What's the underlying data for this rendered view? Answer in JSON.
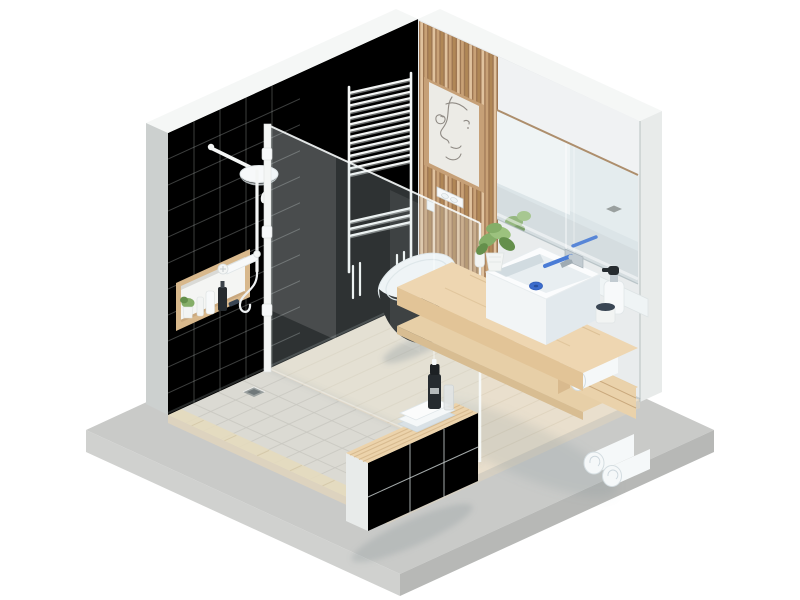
{
  "scene": {
    "label": "isometric-bathroom-3d-render",
    "type": "3d-render",
    "view": "isometric",
    "background": "#ffffff"
  },
  "palette": {
    "bg": "#ffffff",
    "slabTop": "#c9cac8",
    "slabLeft": "#d0d1cf",
    "slabRight": "#b7b8b6",
    "floorWood": "#e9dfcd",
    "plankLine": "#d9cdb6",
    "floorEdgeL": "#ddd3bf",
    "floorEdgeR": "#d5cfc2",
    "showerTile": "#dbdad3",
    "tileGrout": "#c9c8c1",
    "curbTile": "#e4dabe",
    "curbLine": "#d3c6a6",
    "drainMetal": "#9aa09f",
    "drainDark": "#70787a",
    "wallMain": "#eef1f0",
    "wallShower": "#d9dddc",
    "wallTop": "#f5f7f6",
    "wallEnd": "#ccd0cf",
    "wallTileLine": "#c6cccb",
    "rightWall": "#e9eced",
    "pillar": "#e8ebea",
    "pillarEdge": "#d7dad9",
    "slatPanelBg": "#9e7753",
    "slatA": "#e0c29e",
    "slatB": "#c8a176",
    "slatC": "#b08756",
    "frameWood": "#c6a077",
    "matCream": "#ecebe6",
    "lineArt": "#8f8a84",
    "mirrorBase": "#dce5e8",
    "mirrorBright": "#eff4f5",
    "mirrorMid": "#e4ecee",
    "mirrorFloor": "#d5dde0",
    "mirrorTrim": "#ad8e6c",
    "radiatorWhite": "#f4f6f5",
    "radiatorShade": "#d2d7d6",
    "fixtureWhite": "#f7f9fa",
    "fixtureShade": "#dce3e6",
    "fixtureLine": "#c9d2d7",
    "toiletSide": "#d6dee2",
    "nicheWood": "#d8b88c",
    "nicheBack": "#f4f5f3",
    "counterTop": "#eed6b1",
    "counterFront": "#e2c497",
    "shelfWood": "#e7cfa7",
    "shelfFront": "#d8bd92",
    "boxFace": "#ead2ab",
    "boxSide": "#d9ba8e",
    "boxLine": "#c9a87c",
    "towelWhite": "#f5f8f9",
    "towelShade": "#d9e1e6",
    "towelBlue": "#dfeaf2",
    "towelLine": "#cdd7dd",
    "plantGreen": "#85ae68",
    "plantDark": "#648f4b",
    "plantLight": "#9cc27e",
    "potWhite": "#f2f4f3",
    "accentBlue": "#4a7cd6",
    "drainBlue": "#3b6ccc",
    "chrome": "#c2cbd1",
    "chromeDark": "#9fabb3",
    "black": "#262b2f",
    "blackSoft": "#3c434a",
    "navy": "#3a4654",
    "sinkLight": "#f2f5f6",
    "sinkShade": "#e2e9ed",
    "basinInner": "#e8eef1",
    "benchFace": "#eff2f1",
    "benchEnd": "#e8ebea",
    "benchShade": "#d7dddf",
    "benchWood": "#ecd3ab",
    "benchSlat": "#d8bb90",
    "glassFill": "rgba(208,226,230,0.22)",
    "glassEdge": "rgba(248,252,252,0.9)",
    "glassSeam": "rgba(255,255,255,0.5)"
  },
  "objects": [
    {
      "id": "base-slab",
      "label": "concrete platform base"
    },
    {
      "id": "wood-floor",
      "label": "light wood plank floor"
    },
    {
      "id": "shower-floor",
      "label": "tiled shower floor with drain"
    },
    {
      "id": "left-wall",
      "label": "left wall with shower"
    },
    {
      "id": "right-wall",
      "label": "back right wall with mirror"
    },
    {
      "id": "wood-slat-panel",
      "label": "vertical wood slat feature panel"
    },
    {
      "id": "wall-art",
      "label": "framed one-line face drawing"
    },
    {
      "id": "towel-radiator",
      "label": "white ladder towel rack"
    },
    {
      "id": "glass-partition",
      "label": "frameless shower glass screen"
    },
    {
      "id": "shower-set",
      "label": "white rain shower column"
    },
    {
      "id": "shower-niche",
      "label": "wooden wall niche with toiletries"
    },
    {
      "id": "toilet",
      "label": "wall-hung toilet"
    },
    {
      "id": "flush-plate",
      "label": "dual flush plate"
    },
    {
      "id": "mirror",
      "label": "large wall mirror"
    },
    {
      "id": "vanity",
      "label": "floating wood vanity with shelf"
    },
    {
      "id": "sink",
      "label": "square vessel sink with blue drain"
    },
    {
      "id": "faucet",
      "label": "wall faucet with blue lever"
    },
    {
      "id": "soap-dispenser",
      "label": "pump soap dispenser"
    },
    {
      "id": "plant",
      "label": "potted green plant"
    },
    {
      "id": "towels",
      "label": "rolled and folded towels"
    },
    {
      "id": "bench",
      "label": "tiled bench with wood slat top"
    },
    {
      "id": "spray-bottle",
      "label": "black spray bottle"
    }
  ]
}
